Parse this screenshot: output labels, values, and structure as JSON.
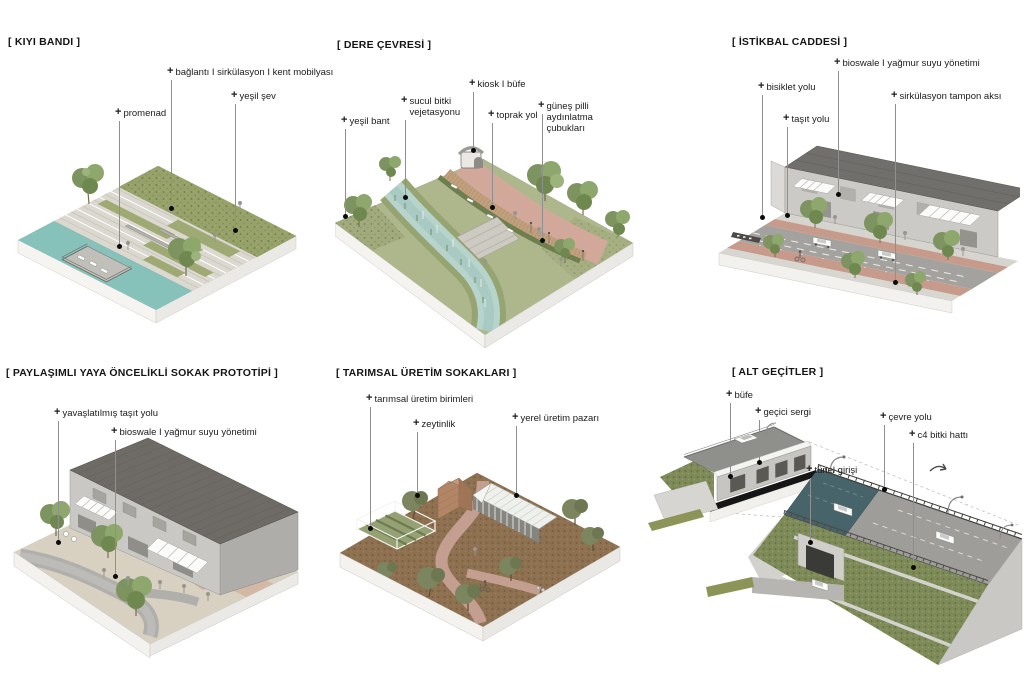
{
  "glyphs": {
    "plus": "+"
  },
  "colors": {
    "background": "#ffffff",
    "label_text": "#1b1b1b",
    "leader_line": "#8f8f8f",
    "leader_dot": "#0a0a0a",
    "water": "#86c1ba",
    "stream": "#b7d4cc",
    "grass": "#97a26a",
    "terrace": "#dbd8cf",
    "pink_path": "#d2a89b",
    "terracotta_lane": "#c69b8c",
    "asphalt": "#a3a29f",
    "roof_dark": "#706f6c",
    "soil_brown": "#8d7150",
    "teal_road": "#47646a"
  },
  "panels": [
    {
      "title": "[ KIYI BANDI ]",
      "labels": [
        {
          "text": "bağlantı I sirkülasyon I kent mobilyası"
        },
        {
          "text": "yeşil şev"
        },
        {
          "text": "promenad"
        }
      ]
    },
    {
      "title": "[ DERE ÇEVRESİ ]",
      "labels": [
        {
          "text": "kiosk I büfe"
        },
        {
          "text": "sucul bitki vejetasyonu"
        },
        {
          "text": "toprak yol"
        },
        {
          "text": "güneş pilli aydınlatma çubukları"
        },
        {
          "text": "yeşil bant"
        }
      ]
    },
    {
      "title": "[ İSTİKBAL CADDESİ ]",
      "labels": [
        {
          "text": "bioswale I yağmur suyu yönetimi"
        },
        {
          "text": "bisiklet yolu"
        },
        {
          "text": "sirkülasyon tampon aksı"
        },
        {
          "text": "taşıt yolu"
        }
      ]
    },
    {
      "title": "[ PAYLAŞIMLI YAYA ÖNCELİKLİ SOKAK PROTOTİPİ ]",
      "labels": [
        {
          "text": "yavaşlatılmış taşıt yolu"
        },
        {
          "text": "bioswale I yağmur suyu yönetimi"
        }
      ]
    },
    {
      "title": "[ TARIMSAL ÜRETİM SOKAKLARI ]",
      "labels": [
        {
          "text": "tarımsal üretim birimleri"
        },
        {
          "text": "zeytinlik"
        },
        {
          "text": "yerel üretim pazarı"
        }
      ]
    },
    {
      "title": "[ ALT GEÇİTLER ]",
      "labels": [
        {
          "text": "büfe"
        },
        {
          "text": "geçici sergi"
        },
        {
          "text": "çevre yolu"
        },
        {
          "text": "c4 bitki hattı"
        },
        {
          "text": "tünel girişi"
        }
      ]
    }
  ]
}
